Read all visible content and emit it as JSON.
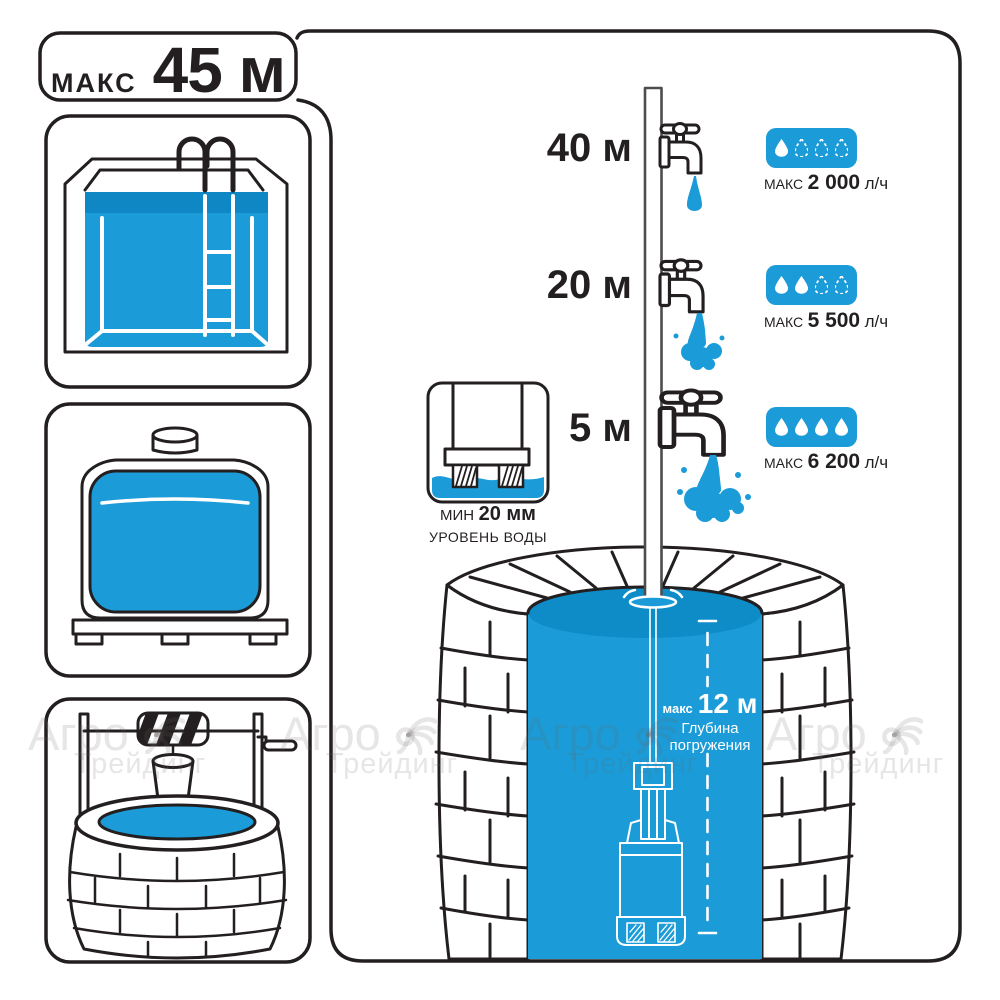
{
  "header": {
    "label": "МАКС",
    "value": "45 м"
  },
  "taps": [
    {
      "height": "40 м",
      "flow_label": "МАКС",
      "flow_value": "2 000",
      "flow_unit": "л/ч",
      "drops_filled": 1,
      "drops_total": 4
    },
    {
      "height": "20 м",
      "flow_label": "МАКС",
      "flow_value": "5 500",
      "flow_unit": "л/ч",
      "drops_filled": 2,
      "drops_total": 4
    },
    {
      "height": "5 м",
      "flow_label": "МАКС",
      "flow_value": "6 200",
      "flow_unit": "л/ч",
      "drops_filled": 4,
      "drops_total": 4
    }
  ],
  "min_level": {
    "label": "МИН",
    "value": "20 мм",
    "caption": "УРОВЕНЬ ВОДЫ"
  },
  "immersion": {
    "label": "макс",
    "value": "12 м",
    "caption1": "Глубина",
    "caption2": "погружения"
  },
  "watermark": {
    "line1": "Агро",
    "line2": "Трейдинг"
  },
  "colors": {
    "water": "#1b9cd8",
    "water_dark": "#0e8cc8",
    "outline": "#231f20",
    "pipe_outline": "#4d4d4d"
  }
}
